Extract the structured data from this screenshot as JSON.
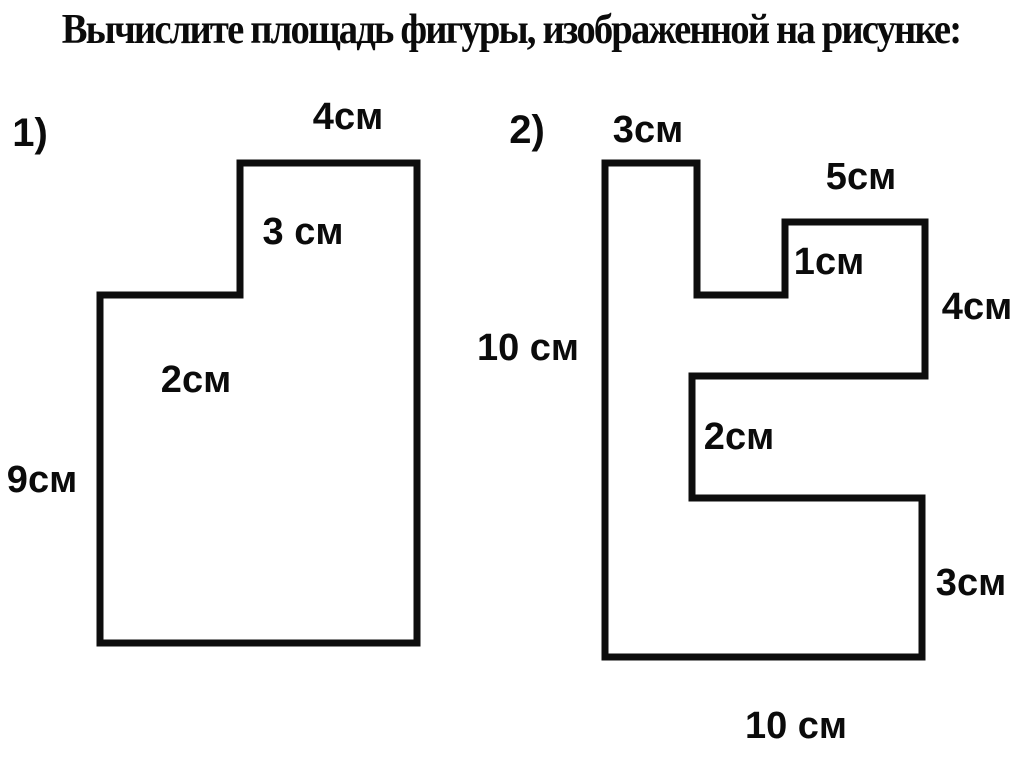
{
  "page": {
    "title": "Вычислите площадь фигуры, изображенной на рисунке:",
    "ink_color": "#0d0d0d",
    "background_color": "#ffffff"
  },
  "figure1": {
    "number": "1)",
    "dimensions": {
      "top_edge": "4см",
      "step_height": "3 см",
      "ledge_width": "2см",
      "left_side": "9см"
    }
  },
  "figure2": {
    "number": "2)",
    "dimensions": {
      "column_top": "3см",
      "upper_block_top": "5см",
      "inner_step": "1см",
      "upper_right_side": "4см",
      "left_side": "10 см",
      "middle_notch": "2см",
      "lower_right_side": "3см",
      "bottom_edge": "10 см"
    }
  }
}
